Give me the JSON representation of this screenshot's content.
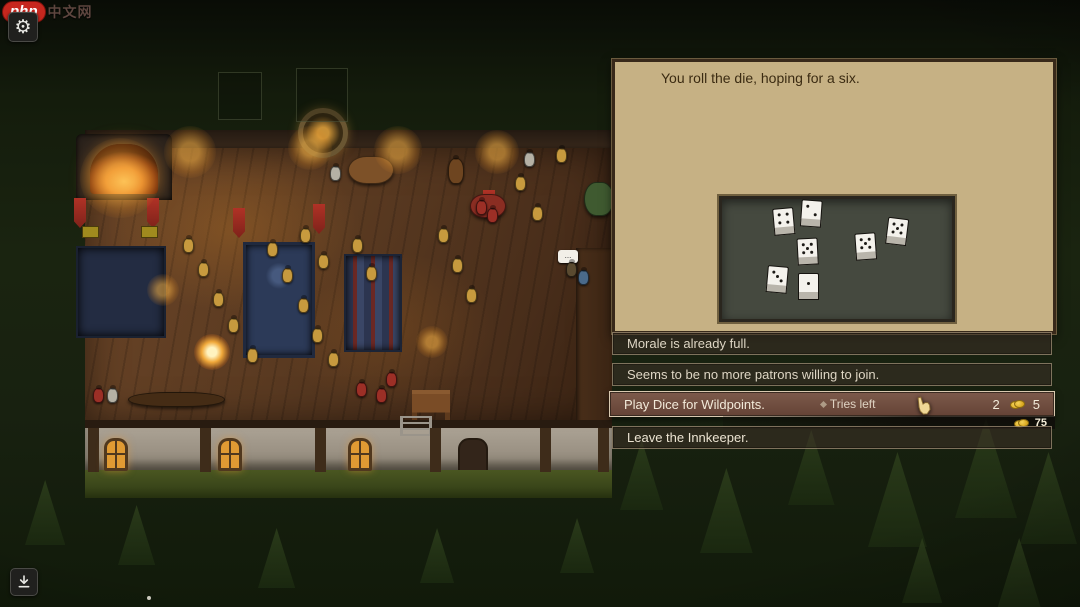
{
  "watermark": {
    "logo": "php",
    "text": "中文网"
  },
  "hud": {
    "settings_icon": "gear",
    "download_icon": "download-arrow"
  },
  "dialog": {
    "prompt": "You roll the die, hoping for a six.",
    "options": [
      {
        "label": "Morale is already full.",
        "state": "disabled"
      },
      {
        "label": "Seems to be no more patrons willing to join.",
        "state": "disabled"
      },
      {
        "label": "Play Dice for Wildpoints.",
        "state": "active",
        "note": "Tries left",
        "tries": "2",
        "cost": "5",
        "coin_icon": "gold-coins"
      },
      {
        "label": "Leave the Innkeeper.",
        "state": "normal"
      }
    ],
    "money": {
      "amount": "75",
      "coin_icon": "gold-coins"
    },
    "bubble_text": "..."
  },
  "dice_board": {
    "dice": [
      {
        "pips": 4,
        "x": 51,
        "y": 9,
        "rot": -5
      },
      {
        "pips": 2,
        "x": 79,
        "y": 1,
        "rot": 4
      },
      {
        "pips": 5,
        "x": 75,
        "y": 39,
        "rot": -3
      },
      {
        "pips": 3,
        "x": 45,
        "y": 67,
        "rot": 5
      },
      {
        "pips": 1,
        "x": 76,
        "y": 74,
        "rot": 0
      },
      {
        "pips": 5,
        "x": 133,
        "y": 34,
        "rot": -4
      },
      {
        "pips": 5,
        "x": 165,
        "y": 19,
        "rot": 7
      }
    ]
  },
  "colors": {
    "panel_bg": "#c6b184",
    "panel_border": "#38291a",
    "board_bg": "#45493f",
    "active_row": "#76564a",
    "coin_gold": "#d9a71f",
    "banner_red": "#a03028"
  },
  "scene": {
    "posts": [
      88,
      200,
      315,
      430,
      540,
      598
    ],
    "windows": [
      {
        "x": 104
      },
      {
        "x": 218
      },
      {
        "x": 348
      }
    ],
    "banners": [
      {
        "x": 74,
        "y": 198
      },
      {
        "x": 147,
        "y": 198
      },
      {
        "x": 233,
        "y": 208
      },
      {
        "x": 313,
        "y": 204
      },
      {
        "x": 483,
        "y": 190
      }
    ],
    "signs": [
      {
        "x": 82,
        "y": 226
      },
      {
        "x": 141,
        "y": 226
      }
    ],
    "grid_squares": [
      {
        "x": 218,
        "y": 72,
        "w": 42,
        "h": 46
      },
      {
        "x": 296,
        "y": 68,
        "w": 50,
        "h": 52
      }
    ],
    "glows": [
      {
        "x": 190,
        "y": 152,
        "r": 26
      },
      {
        "x": 310,
        "y": 148,
        "r": 22
      },
      {
        "x": 398,
        "y": 150,
        "r": 24
      },
      {
        "x": 497,
        "y": 152,
        "r": 22
      },
      {
        "x": 163,
        "y": 290,
        "r": 16
      },
      {
        "x": 432,
        "y": 342,
        "r": 16
      },
      {
        "x": 212,
        "y": 352,
        "r": 18,
        "bright": true
      },
      {
        "x": 120,
        "y": 178,
        "r": 40
      }
    ],
    "tables": [
      {
        "x": 348,
        "y": 156,
        "w": 44,
        "h": 26,
        "c": "#7d5128"
      },
      {
        "x": 470,
        "y": 194,
        "w": 34,
        "h": 22,
        "c": "#8a2d22"
      },
      {
        "x": 128,
        "y": 392,
        "w": 95,
        "h": 13,
        "c": "#452c15"
      },
      {
        "x": 584,
        "y": 182,
        "w": 28,
        "h": 32,
        "c": "#3f5a30"
      }
    ],
    "characters": [
      {
        "x": 183,
        "y": 238,
        "c": "#c79a3e"
      },
      {
        "x": 198,
        "y": 262,
        "c": "#c79a3e"
      },
      {
        "x": 213,
        "y": 292,
        "c": "#c79a3e"
      },
      {
        "x": 228,
        "y": 318,
        "c": "#c79a3e"
      },
      {
        "x": 267,
        "y": 242,
        "c": "#c79a3e"
      },
      {
        "x": 282,
        "y": 268,
        "c": "#c79a3e"
      },
      {
        "x": 298,
        "y": 298,
        "c": "#c79a3e"
      },
      {
        "x": 312,
        "y": 328,
        "c": "#c79a3e"
      },
      {
        "x": 247,
        "y": 348,
        "c": "#c79a3e"
      },
      {
        "x": 328,
        "y": 352,
        "c": "#c79a3e"
      },
      {
        "x": 352,
        "y": 238,
        "c": "#c79a3e"
      },
      {
        "x": 366,
        "y": 266,
        "c": "#c79a3e"
      },
      {
        "x": 300,
        "y": 228,
        "c": "#c79a3e"
      },
      {
        "x": 318,
        "y": 254,
        "c": "#c79a3e"
      },
      {
        "x": 438,
        "y": 228,
        "c": "#c79a3e"
      },
      {
        "x": 452,
        "y": 258,
        "c": "#c79a3e"
      },
      {
        "x": 466,
        "y": 288,
        "c": "#c79a3e"
      },
      {
        "x": 515,
        "y": 176,
        "c": "#c79a3e"
      },
      {
        "x": 532,
        "y": 206,
        "c": "#c79a3e"
      },
      {
        "x": 556,
        "y": 148,
        "c": "#c79a3e"
      },
      {
        "x": 356,
        "y": 382,
        "c": "#9c2f26"
      },
      {
        "x": 376,
        "y": 388,
        "c": "#9c2f26"
      },
      {
        "x": 386,
        "y": 372,
        "c": "#9c2f26"
      },
      {
        "x": 476,
        "y": 200,
        "c": "#9c2f26"
      },
      {
        "x": 487,
        "y": 208,
        "c": "#9c2f26"
      },
      {
        "x": 93,
        "y": 388,
        "c": "#9c2f26"
      },
      {
        "x": 107,
        "y": 388,
        "c": "#b5b1a5"
      },
      {
        "x": 524,
        "y": 152,
        "c": "#b5b1a5"
      },
      {
        "x": 330,
        "y": 166,
        "c": "#b5b1a5"
      },
      {
        "x": 448,
        "y": 158,
        "c": "#6e4520",
        "w": 14,
        "h": 24
      },
      {
        "x": 578,
        "y": 270,
        "c": "#4a6a8a"
      },
      {
        "x": 566,
        "y": 262,
        "c": "#5a4a30"
      }
    ],
    "trees": [
      {
        "x": 620,
        "y": 440,
        "s": 70
      },
      {
        "x": 700,
        "y": 468,
        "s": 85
      },
      {
        "x": 788,
        "y": 430,
        "s": 75
      },
      {
        "x": 868,
        "y": 452,
        "s": 95
      },
      {
        "x": 955,
        "y": 418,
        "s": 100
      },
      {
        "x": 1020,
        "y": 452,
        "s": 92
      },
      {
        "x": 560,
        "y": 518,
        "s": 55
      },
      {
        "x": 420,
        "y": 528,
        "s": 55
      },
      {
        "x": 258,
        "y": 528,
        "s": 60
      },
      {
        "x": 118,
        "y": 505,
        "s": 60
      },
      {
        "x": 25,
        "y": 480,
        "s": 65
      },
      {
        "x": 902,
        "y": 538,
        "s": 65
      },
      {
        "x": 995,
        "y": 538,
        "s": 78
      }
    ]
  }
}
